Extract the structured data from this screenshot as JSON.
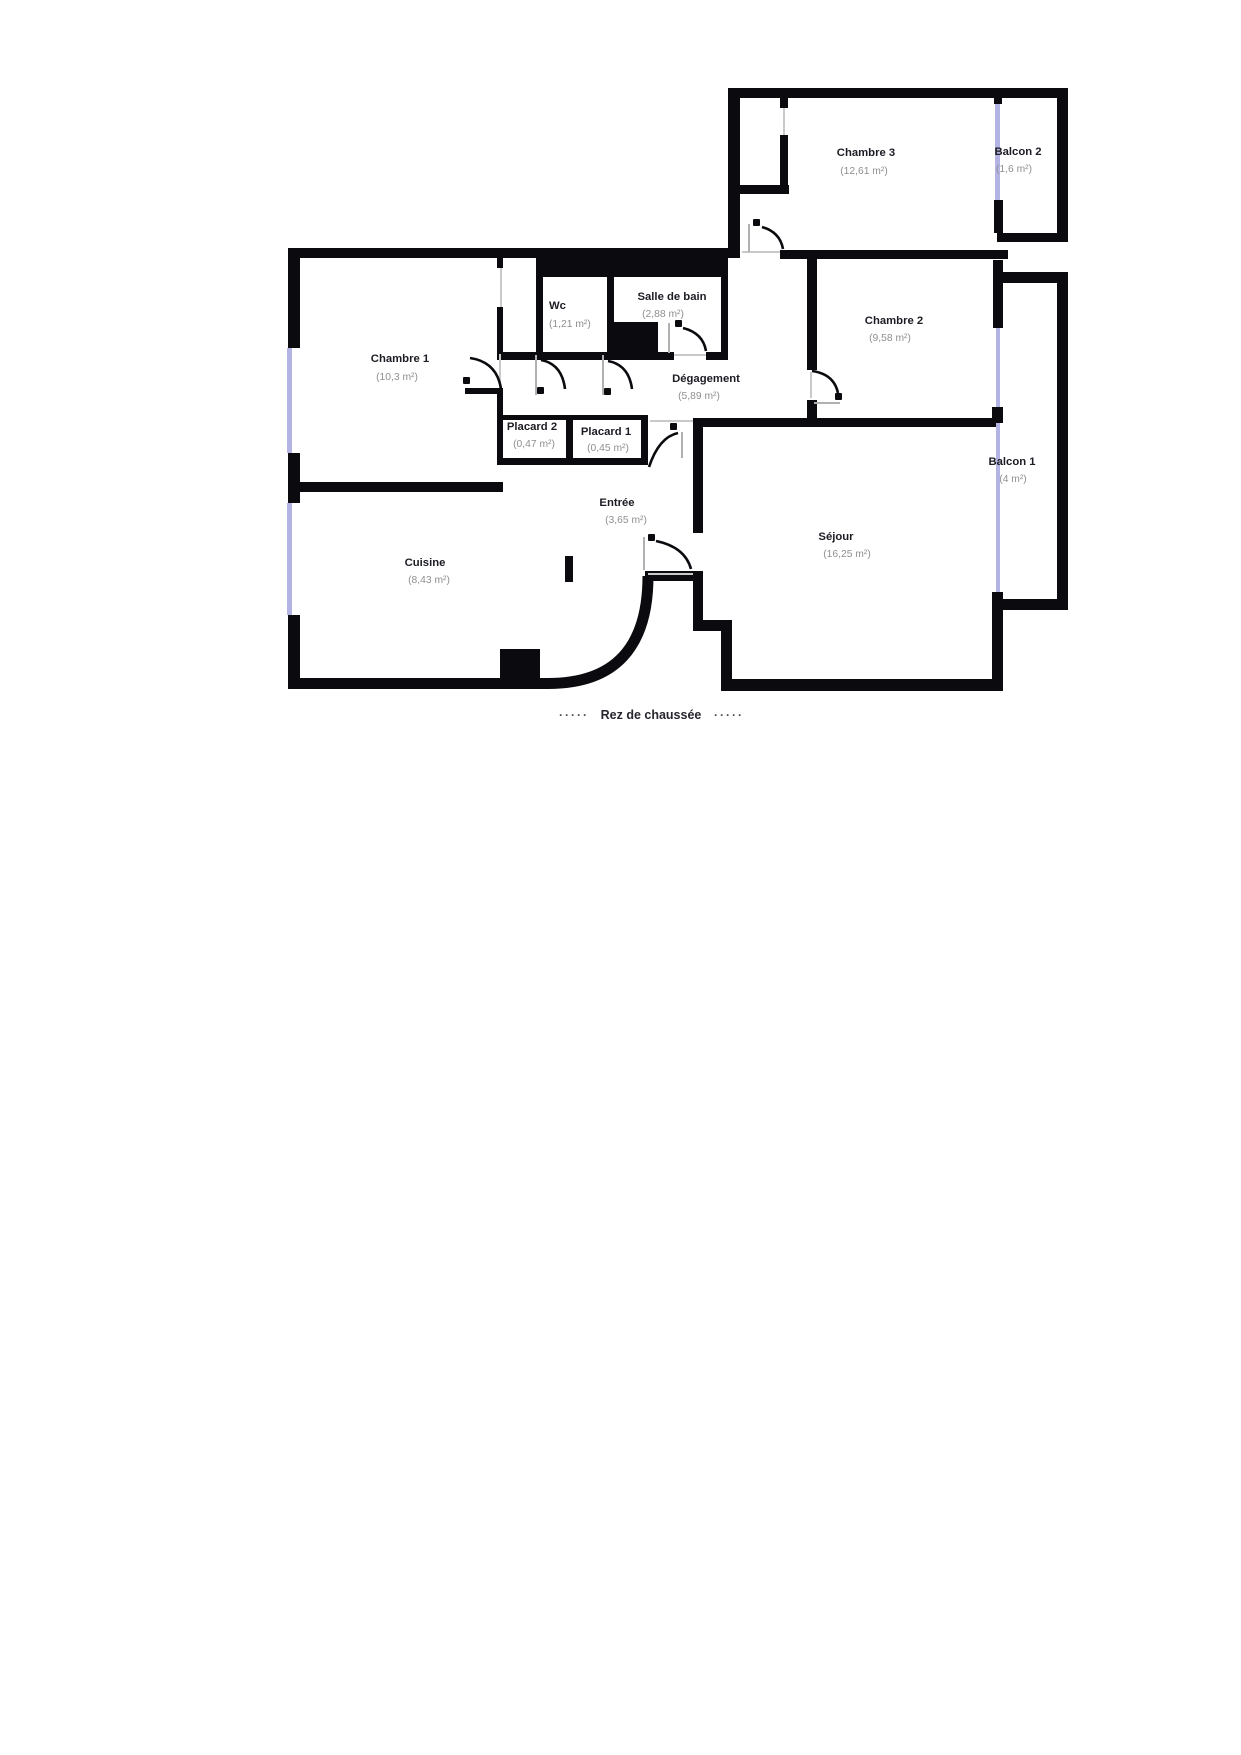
{
  "plan": {
    "floor_caption": "Rez de chaussée",
    "caption_left_dashes": "·····",
    "caption_right_dashes": "·····"
  },
  "colors": {
    "wall": "#0b0b0f",
    "window": "#b4b4e4",
    "door_leaf": "#b0b0b0",
    "threshold": "#c9c9c9",
    "room_name_text": "#1c1c24",
    "room_area_text": "#8f8f93",
    "background": "#ffffff"
  },
  "rooms": [
    {
      "id": "chambre-3",
      "name": "Chambre 3",
      "area": "(12,61 m²)"
    },
    {
      "id": "balcon-2",
      "name": "Balcon 2",
      "area": "(1,6 m²)"
    },
    {
      "id": "chambre-1",
      "name": "Chambre 1",
      "area": "(10,3 m²)"
    },
    {
      "id": "wc",
      "name": "Wc",
      "area": "(1,21 m²)"
    },
    {
      "id": "salle-de-bain",
      "name": "Salle de bain",
      "area": "(2,88 m²)"
    },
    {
      "id": "chambre-2",
      "name": "Chambre 2",
      "area": "(9,58 m²)"
    },
    {
      "id": "degagement",
      "name": "Dégagement",
      "area": "(5,89 m²)"
    },
    {
      "id": "placard-2",
      "name": "Placard 2",
      "area": "(0,47 m²)"
    },
    {
      "id": "placard-1",
      "name": "Placard 1",
      "area": "(0,45 m²)"
    },
    {
      "id": "balcon-1",
      "name": "Balcon 1",
      "area": "(4 m²)"
    },
    {
      "id": "entree",
      "name": "Entrée",
      "area": "(3,65 m²)"
    },
    {
      "id": "cuisine",
      "name": "Cuisine",
      "area": "(8,43 m²)"
    },
    {
      "id": "sejour",
      "name": "Séjour",
      "area": "(16,25 m²)"
    }
  ]
}
